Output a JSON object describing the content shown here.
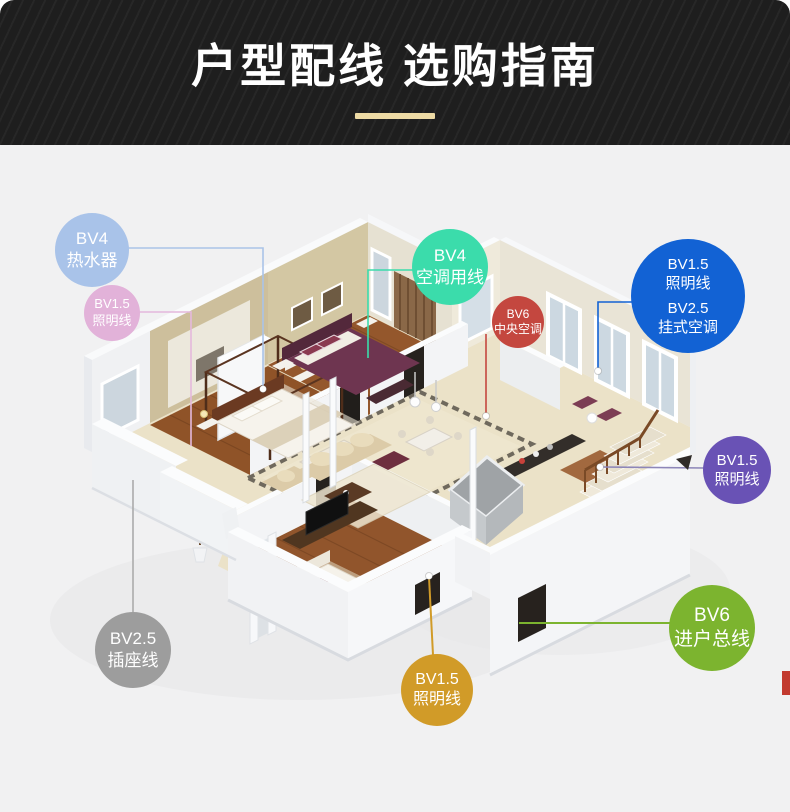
{
  "page": {
    "background": "#f1f1f2"
  },
  "header": {
    "title": "户型配线 选购指南",
    "background": "#1e1e1e",
    "title_color": "#ffffff",
    "accent_bar_color": "#eddaa4"
  },
  "annotations": {
    "badges": [
      {
        "id": "water-heater",
        "spec": "BV4",
        "label": "热水器",
        "color": "#a9c3e9",
        "line_color": "#aac4e8",
        "cx": 92,
        "cy": 250,
        "r": 37
      },
      {
        "id": "lighting-left",
        "spec": "BV1.5",
        "label": "照明线",
        "color": "#e2b2d9",
        "line_color": "#e4b8dc",
        "cx": 112,
        "cy": 313,
        "r": 28
      },
      {
        "id": "ac-line",
        "spec": "BV4",
        "label": "空调用线",
        "color": "#3bdcab",
        "line_color": "#3bdcab",
        "cx": 450,
        "cy": 267,
        "r": 38
      },
      {
        "id": "central-ac",
        "spec": "BV6",
        "label": "中央空调",
        "color": "#c4473f",
        "line_color": "#c4473f",
        "cx": 518,
        "cy": 322,
        "r": 26
      },
      {
        "id": "wall-ac",
        "spec": "BV1.5",
        "label": "照明线",
        "spec2": "BV2.5",
        "label2": "挂式空调",
        "lines": 4,
        "color": "#1262d4",
        "line_color": "#1262d4",
        "cx": 688,
        "cy": 296,
        "r": 57
      },
      {
        "id": "lighting-right",
        "spec": "BV1.5",
        "label": "照明线",
        "color": "#6952b5",
        "line_color": "#8d86b8",
        "cx": 737,
        "cy": 470,
        "r": 34
      },
      {
        "id": "main-incoming",
        "spec": "BV6",
        "label": "进户总线",
        "color": "#7cb42f",
        "line_color": "#7cb42f",
        "cx": 712,
        "cy": 628,
        "r": 43
      },
      {
        "id": "socket-line",
        "spec": "BV2.5",
        "label": "插座线",
        "color": "#9d9d9d",
        "line_color": "#ababab",
        "cx": 133,
        "cy": 650,
        "r": 38
      },
      {
        "id": "lighting-bottom",
        "spec": "BV1.5",
        "label": "照明线",
        "color": "#d19b28",
        "line_color": "#d19b28",
        "cx": 437,
        "cy": 690,
        "r": 36
      }
    ]
  }
}
